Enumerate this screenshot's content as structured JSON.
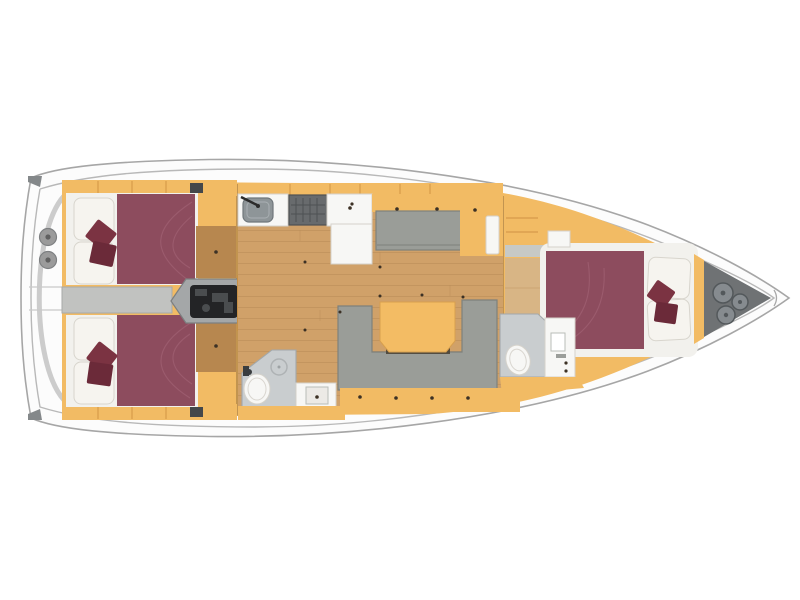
{
  "diagram": {
    "type": "floor-plan",
    "subject": "Sailing yacht interior layout plan, top view, bow to the right",
    "orientation": {
      "bow": "right",
      "stern": "left"
    },
    "areas": [
      {
        "id": "transom",
        "label": "Transom with twin helm winches"
      },
      {
        "id": "aft-cabin-port",
        "label": "Aft double cabin (top)"
      },
      {
        "id": "aft-cabin-starboard",
        "label": "Aft double cabin (bottom)"
      },
      {
        "id": "companionway",
        "label": "Companionway steps over engine compartment"
      },
      {
        "id": "galley",
        "label": "Galley with sink, stove and counters"
      },
      {
        "id": "settee",
        "label": "Straight settee"
      },
      {
        "id": "salon",
        "label": "Salon with U-shaped sofa and folding table"
      },
      {
        "id": "aft-head",
        "label": "Aft bathroom with toilet, shower and sink"
      },
      {
        "id": "forward-head",
        "label": "Forward bathroom with toilet and sink"
      },
      {
        "id": "forward-cabin",
        "label": "Forward double cabin"
      },
      {
        "id": "anchor-locker",
        "label": "Bow anchor locker with rope coils"
      }
    ]
  },
  "colors": {
    "hull_fill": "#fcfcfc",
    "hull_stroke": "#a6a6a6",
    "deck_line": "#b8b8b8",
    "transom_arc": "#c7c7c7",
    "corner_cap": "#84888a",
    "winch": "#9b9b9b",
    "winch_dark": "#606060",
    "interior_orange": "#f2bb64",
    "orange_shade": "#cf9345",
    "wood_floor": "#d0a169",
    "wood_line": "#b68a55",
    "wood_dark_locker": "#b7874f",
    "mattress": "#8d4c5e",
    "mattress_seam": "#a56678",
    "bedding": "#f6f4ef",
    "bedding_stroke": "#d8d5cd",
    "platform_white": "#f2f1ed",
    "cushion": "#7b3342",
    "cushion2": "#6b2a39",
    "sofa": "#9a9d98",
    "sofa_shade": "#7e817c",
    "table": "#f3bc64",
    "table_edge": "#d79f4e",
    "table_shadow": "#463f33",
    "engine_housing": "#a4a7a8",
    "engine_stroke": "#7c7f80",
    "engine_dark": "#232426",
    "engine_mid": "#4a4d4f",
    "steps_base": "#c89045",
    "step_face": "#f4c87b",
    "step_gap": "#b5854a",
    "bath_floor": "#c9cdcf",
    "bath_wall": "#a2a8ab",
    "fixture_white": "#f7f7f5",
    "fixture_stroke": "#d5d2cb",
    "sink_gray": "#8e9598",
    "stove": "#686b6d",
    "stove_line": "#4e5153",
    "corridor": "#c1c2c0",
    "headboard_gray": "#c7c9c6",
    "anchor_locker": "#6f7274",
    "rope": "#868b8f",
    "rope_dark": "#53585b",
    "dot": "#3c3125",
    "bulkhead_line": "#a37a42",
    "fwd_floor": "#d8b585"
  }
}
